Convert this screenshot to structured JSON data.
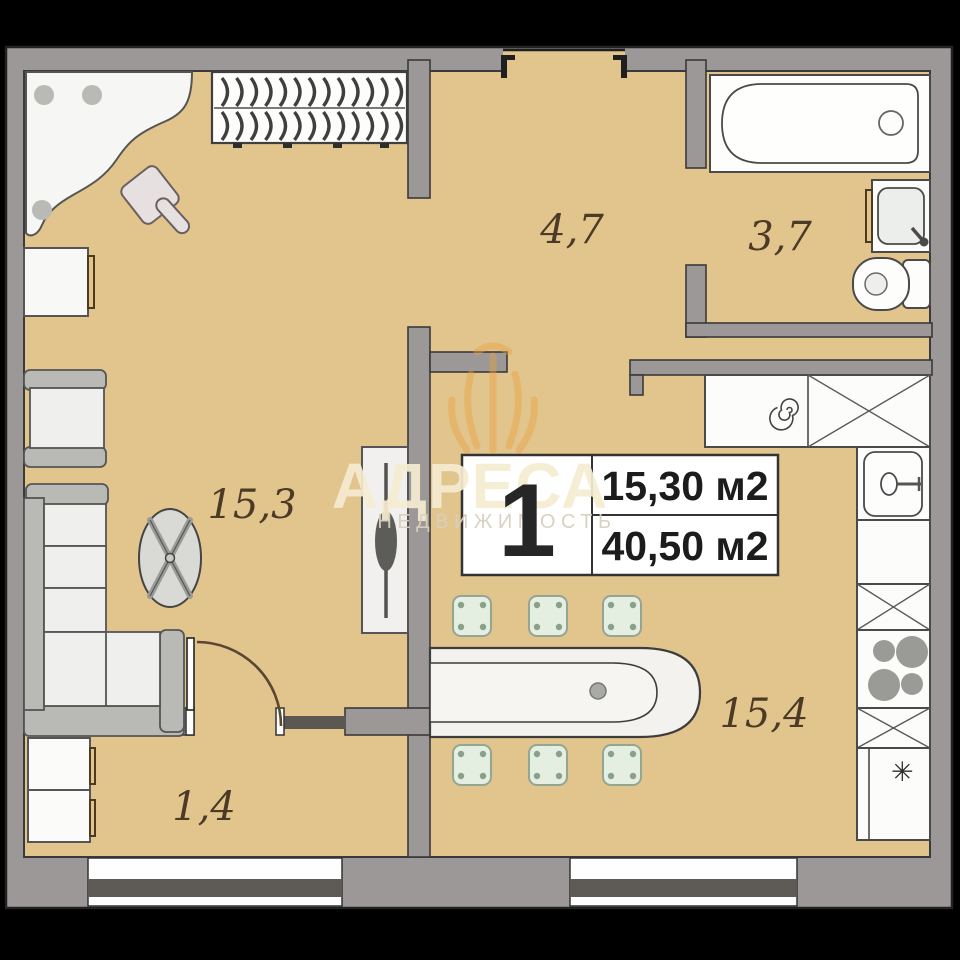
{
  "plan": {
    "unit_badge": {
      "number": "1",
      "living_area": "15,30 м2",
      "total_area": "40,50 м2"
    },
    "rooms": {
      "hall": {
        "label": "4,7"
      },
      "bathroom": {
        "label": "3,7"
      },
      "living": {
        "label": "15,3"
      },
      "kitchen": {
        "label": "15,4"
      },
      "entry": {
        "label": "1,4"
      }
    },
    "watermark": {
      "brand": "АДРЕСА",
      "subtitle": "НЕДВИЖИМОСТЬ"
    },
    "icons": {
      "fridge_snowflake": "✳"
    },
    "colors": {
      "floor": "#e2c48d",
      "wall": "#9b9897",
      "outline": "#333333",
      "furniture": "#fbfbf9",
      "window_glass": "#5e5b57",
      "watermark_accent": "#e8a23c",
      "stool": "#e4efe2"
    }
  }
}
